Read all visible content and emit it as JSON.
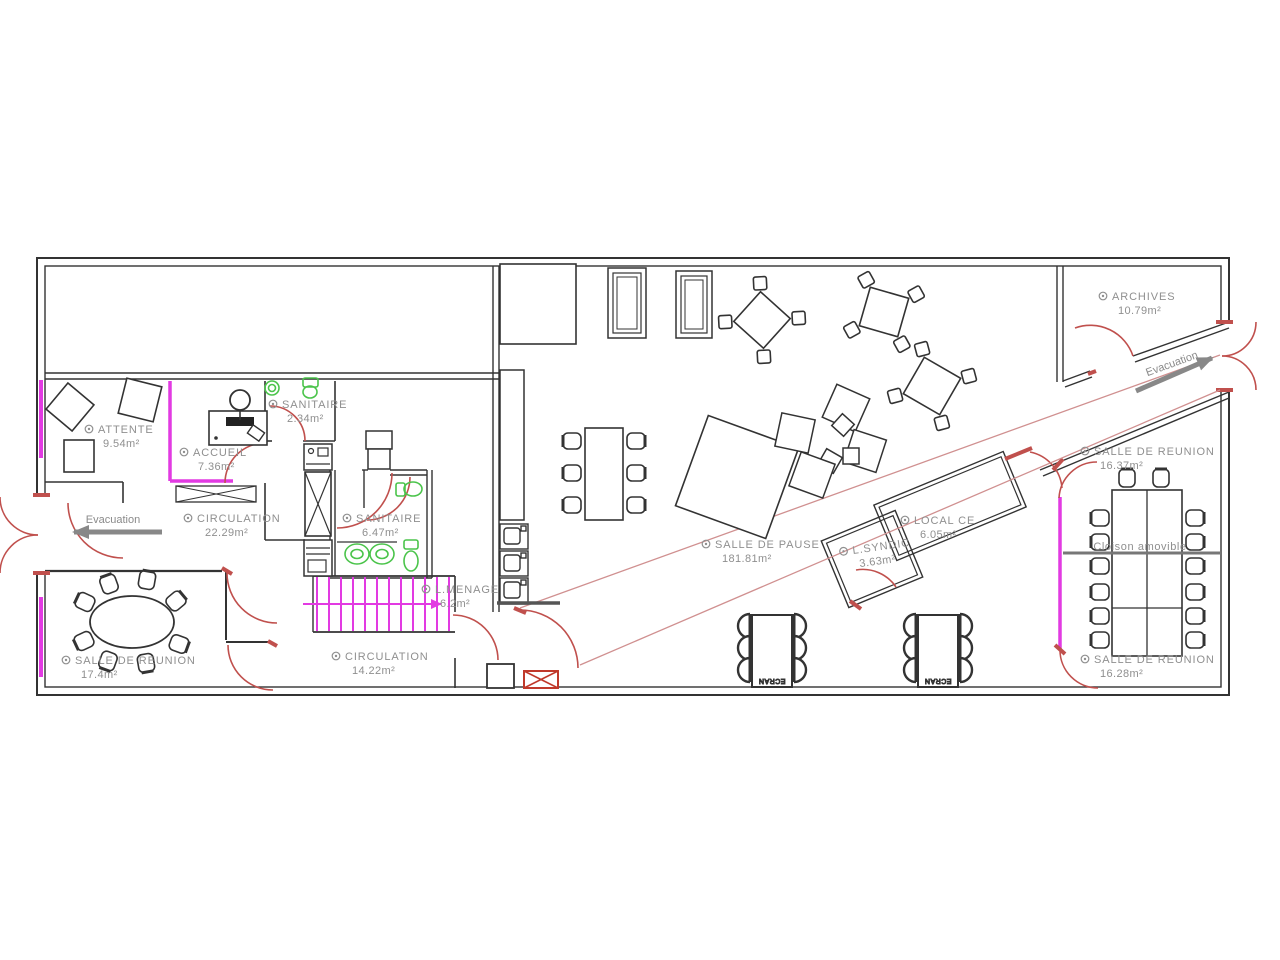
{
  "plan": {
    "rooms": [
      {
        "name": "ARCHIVES",
        "area": "10.79m²"
      },
      {
        "name": "ATTENTE",
        "area": "9.54m²"
      },
      {
        "name": "SANITAIRE",
        "area": "2.34m²"
      },
      {
        "name": "ACCUEIL",
        "area": "7.36m²"
      },
      {
        "name": "CIRCULATION",
        "area": "22.29m²"
      },
      {
        "name": "SANITAIRE",
        "area": "6.47m²"
      },
      {
        "name": "L.MENAGE",
        "area": "6.2m²"
      },
      {
        "name": "SALLE DE REUNION",
        "area": "17.4m²"
      },
      {
        "name": "CIRCULATION",
        "area": "14.22m²"
      },
      {
        "name": "SALLE DE PAUSE",
        "area": "181.81m²"
      },
      {
        "name": "L.SYNDIC",
        "area": "3.63m²"
      },
      {
        "name": "LOCAL CE",
        "area": "6.05m²"
      },
      {
        "name": "SALLE DE REUNION",
        "area": "16.37m²"
      },
      {
        "name": "SALLE DE REUNION",
        "area": "16.28m²"
      }
    ],
    "annotations": {
      "evacuation_left": "Evacuation",
      "evacuation_right": "Evacuation",
      "partition": "Cloison amovible",
      "screen_label": "ECRAN"
    },
    "colors": {
      "wall": "#333333",
      "door_red": "#c0504d",
      "partition_magenta": "#e23ae2",
      "fixture_green": "#4bc44b",
      "label_gray": "#8f8f8f",
      "evacuation_path_red": "#d09090",
      "arrow_gray": "#888888"
    }
  }
}
